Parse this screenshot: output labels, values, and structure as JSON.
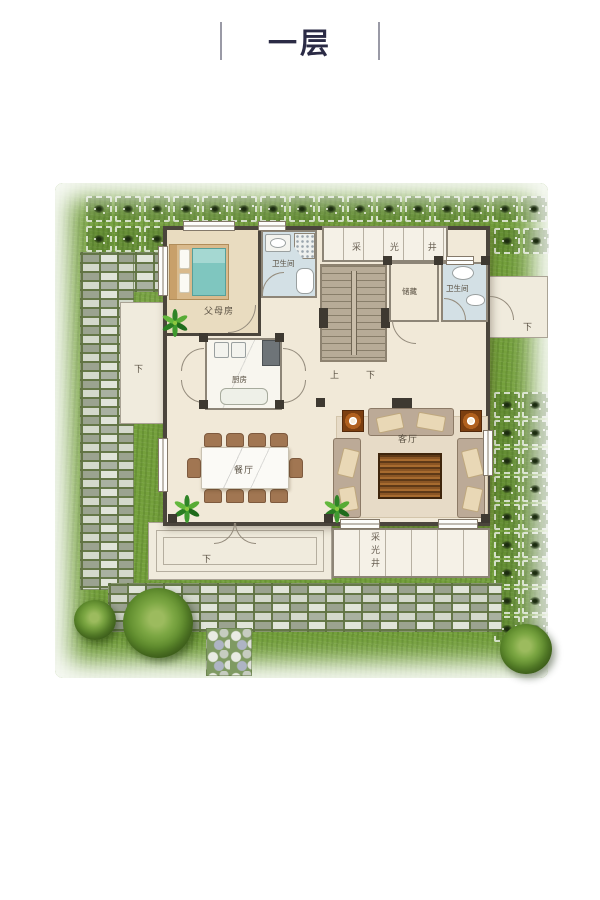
{
  "title": {
    "text": "一层"
  },
  "rooms": {
    "master_bedroom": "父母房",
    "bathroom_1": "卫生间",
    "bathroom_2": "卫生间",
    "storage": "储藏",
    "kitchen": "厨房",
    "dining": "餐厅",
    "living": "客厅",
    "light_well_top": "采 光 井",
    "light_well_bottom": "采光井"
  },
  "stairs": {
    "up": "上",
    "down": "下"
  },
  "steps": {
    "front": "下",
    "left": "下",
    "right": "下"
  },
  "colors": {
    "title_text": "#2b2b45",
    "lawn_green": "#74a03c",
    "wall_dark": "#4b453c",
    "floor_cream": "#f1e9d8",
    "bedroom_floor": "#e9dcc0",
    "bathroom_floor": "#d3e0e5",
    "bed_teal": "#7fc6bf",
    "sofa_taupe": "#bcaa97",
    "coffee_table_wood": "#8a5524",
    "speaker_orange": "#b0601e"
  }
}
